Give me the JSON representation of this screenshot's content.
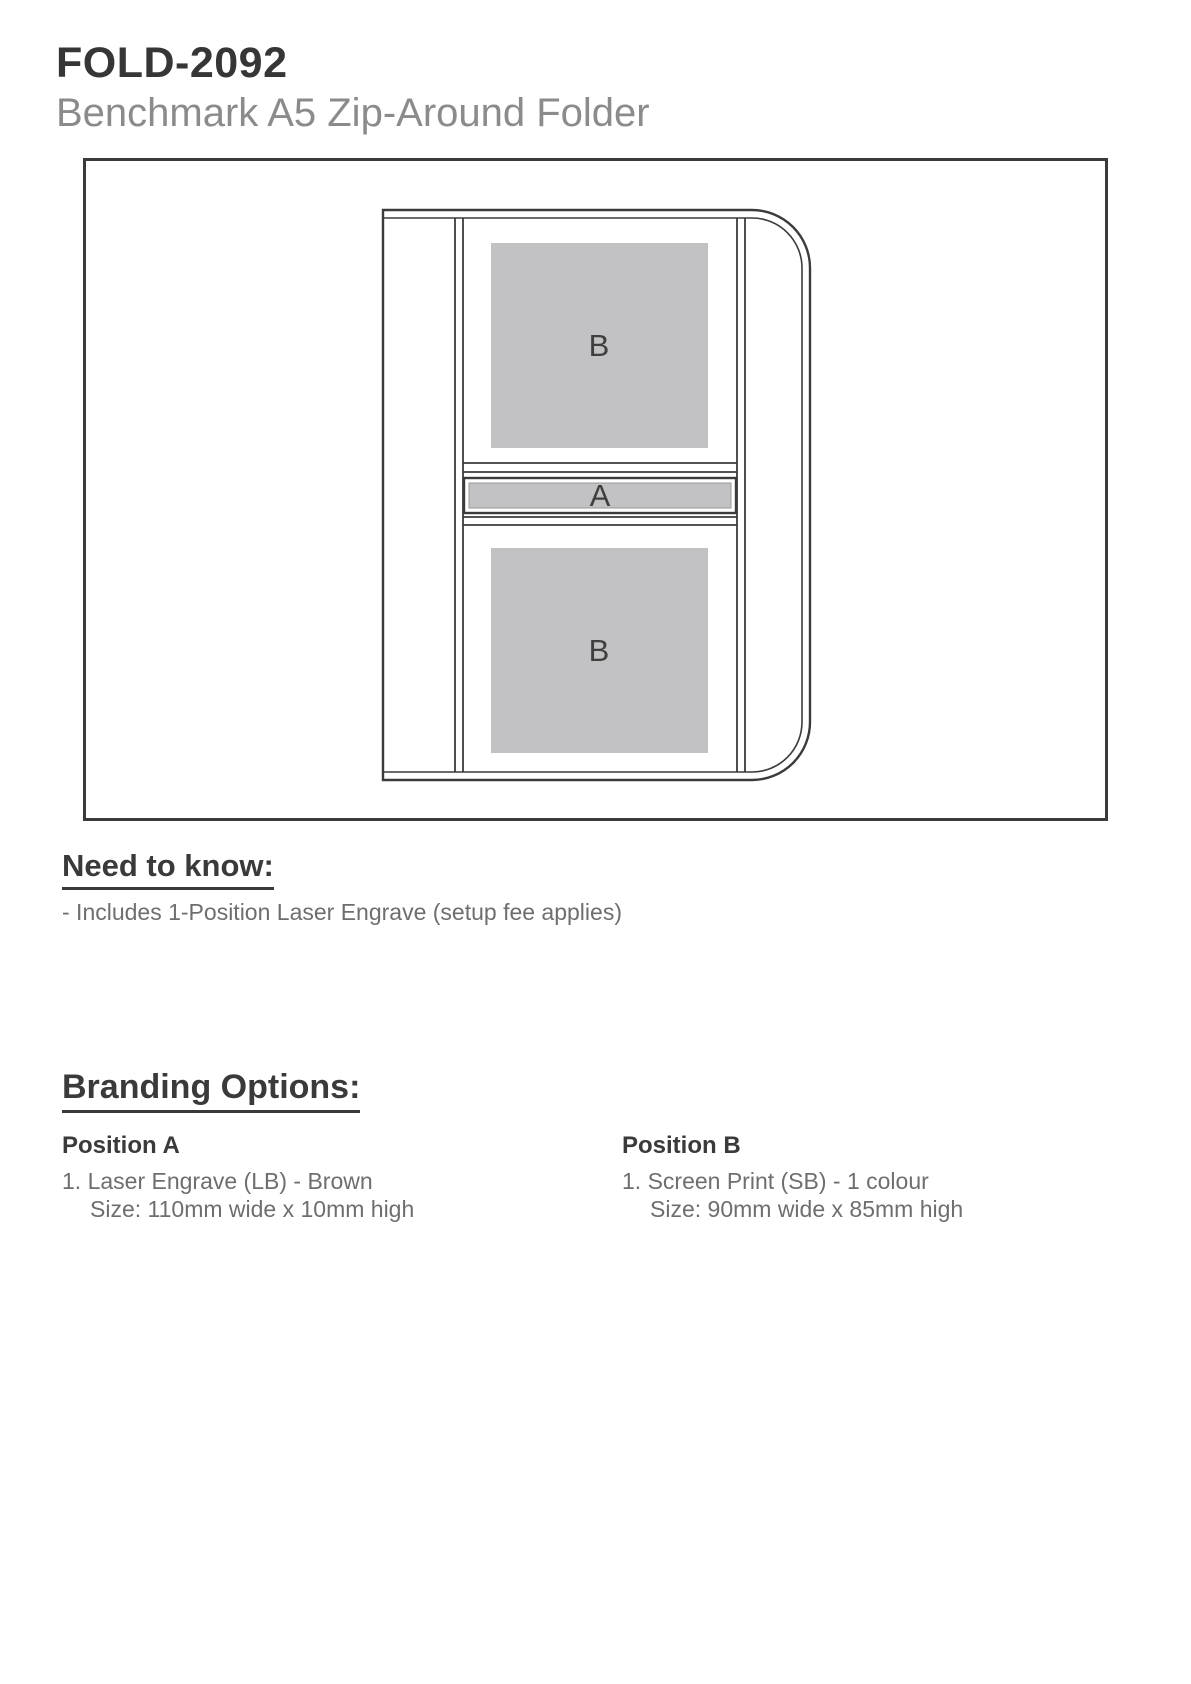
{
  "header": {
    "product_code": "FOLD-2092",
    "product_name": "Benchmark A5 Zip-Around Folder"
  },
  "diagram": {
    "label_a": "A",
    "label_b": "B",
    "fill_gray": "#c2c2c4",
    "line_color": "#3b3b3b"
  },
  "need_to_know": {
    "heading": "Need to know:",
    "note": "- Includes 1-Position Laser Engrave (setup fee applies)"
  },
  "branding_options": {
    "heading": "Branding Options:",
    "columns": [
      {
        "title": "Position A",
        "line1": "1. Laser Engrave (LB) - Brown",
        "line2": "Size: 110mm wide x 10mm high"
      },
      {
        "title": "Position B",
        "line1": "1. Screen Print (SB) - 1 colour",
        "line2": "Size: 90mm wide x 85mm high"
      }
    ]
  }
}
